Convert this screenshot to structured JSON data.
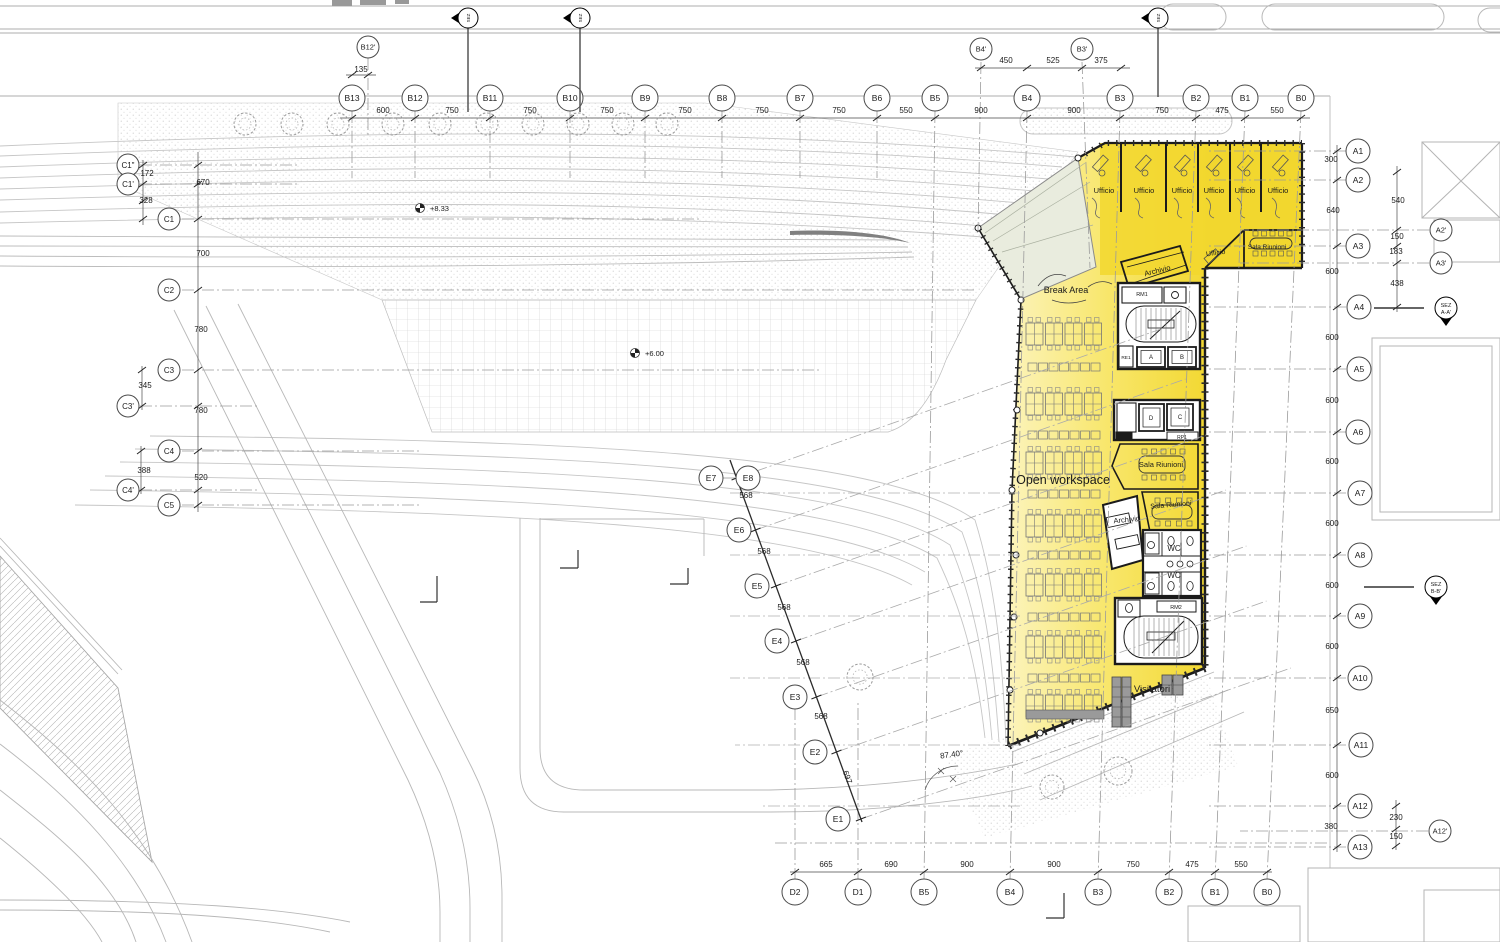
{
  "title": "Office floor plan – first floor (piano primo)",
  "colors": {
    "highlight": "#F2D72E",
    "highlight_pale": "#FCF4BE",
    "glass": "#E9ECDE",
    "wall": "#1B1B1B",
    "desk_gray": "#9A9A9A",
    "line_gray": "#9B9B9B"
  },
  "axes": {
    "groups": [
      {
        "name": "top-b",
        "r": 13,
        "fs": 8.5,
        "tick": "top",
        "items": [
          {
            "id": "B13",
            "x": 352,
            "y": 98
          },
          {
            "id": "B12",
            "x": 415,
            "y": 98
          },
          {
            "id": "B11",
            "x": 490,
            "y": 98
          },
          {
            "id": "B10",
            "x": 570,
            "y": 98
          },
          {
            "id": "B9",
            "x": 645,
            "y": 98
          },
          {
            "id": "B8",
            "x": 722,
            "y": 98
          },
          {
            "id": "B7",
            "x": 800,
            "y": 98
          },
          {
            "id": "B6",
            "x": 877,
            "y": 98
          },
          {
            "id": "B5",
            "x": 935,
            "y": 98
          },
          {
            "id": "B4",
            "x": 1027,
            "y": 98
          },
          {
            "id": "B3",
            "x": 1120,
            "y": 98
          },
          {
            "id": "B2",
            "x": 1196,
            "y": 98
          },
          {
            "id": "B1",
            "x": 1245,
            "y": 98
          },
          {
            "id": "B0",
            "x": 1301,
            "y": 98
          }
        ]
      },
      {
        "name": "top-b-secondary",
        "r": 11,
        "fs": 7.5,
        "tick": "none",
        "items": [
          {
            "id": "B12'",
            "x": 368,
            "y": 47
          },
          {
            "id": "B4'",
            "x": 981,
            "y": 49
          },
          {
            "id": "B3'",
            "x": 1082,
            "y": 49
          }
        ]
      },
      {
        "name": "bottom",
        "r": 13,
        "fs": 8.5,
        "tick": "bottom",
        "items": [
          {
            "id": "D2",
            "x": 795,
            "y": 892
          },
          {
            "id": "D1",
            "x": 858,
            "y": 892
          },
          {
            "id": "B5",
            "x": 924,
            "y": 892
          },
          {
            "id": "B4",
            "x": 1010,
            "y": 892
          },
          {
            "id": "B3",
            "x": 1098,
            "y": 892
          },
          {
            "id": "B2",
            "x": 1169,
            "y": 892
          },
          {
            "id": "B1",
            "x": 1215,
            "y": 892
          },
          {
            "id": "B0",
            "x": 1267,
            "y": 892
          }
        ]
      },
      {
        "name": "left-c",
        "r": 11,
        "fs": 8,
        "tick": "left",
        "items": [
          {
            "id": "C1\"",
            "x": 128,
            "y": 165
          },
          {
            "id": "C1'",
            "x": 128,
            "y": 184
          },
          {
            "id": "C1",
            "x": 169,
            "y": 219
          },
          {
            "id": "C2",
            "x": 169,
            "y": 290
          },
          {
            "id": "C3",
            "x": 169,
            "y": 370
          },
          {
            "id": "C3'",
            "x": 128,
            "y": 406
          },
          {
            "id": "C4",
            "x": 169,
            "y": 451
          },
          {
            "id": "C4'",
            "x": 128,
            "y": 490
          },
          {
            "id": "C5",
            "x": 169,
            "y": 505
          }
        ]
      },
      {
        "name": "right-a",
        "r": 12,
        "fs": 8.5,
        "tick": "right",
        "items": [
          {
            "id": "A1",
            "x": 1358,
            "y": 151
          },
          {
            "id": "A2",
            "x": 1358,
            "y": 180
          },
          {
            "id": "A3",
            "x": 1358,
            "y": 246
          },
          {
            "id": "A4",
            "x": 1359,
            "y": 307
          },
          {
            "id": "A5",
            "x": 1359,
            "y": 369
          },
          {
            "id": "A6",
            "x": 1358,
            "y": 432
          },
          {
            "id": "A7",
            "x": 1360,
            "y": 493
          },
          {
            "id": "A8",
            "x": 1360,
            "y": 555
          },
          {
            "id": "A9",
            "x": 1360,
            "y": 616
          },
          {
            "id": "A10",
            "x": 1360,
            "y": 678
          },
          {
            "id": "A11",
            "x": 1361,
            "y": 745
          },
          {
            "id": "A12",
            "x": 1360,
            "y": 806
          },
          {
            "id": "A13",
            "x": 1360,
            "y": 847
          }
        ]
      },
      {
        "name": "right-a-secondary",
        "r": 11,
        "fs": 7.5,
        "tick": "none",
        "items": [
          {
            "id": "A2'",
            "x": 1441,
            "y": 230
          },
          {
            "id": "A3'",
            "x": 1441,
            "y": 263
          },
          {
            "id": "A12'",
            "x": 1440,
            "y": 831
          }
        ]
      },
      {
        "name": "e-axis",
        "r": 12,
        "fs": 8.5,
        "tick": "e",
        "items": [
          {
            "id": "E7",
            "x": 711,
            "y": 478
          },
          {
            "id": "E8",
            "x": 748,
            "y": 478
          },
          {
            "id": "E6",
            "x": 739,
            "y": 530
          },
          {
            "id": "E5",
            "x": 757,
            "y": 586
          },
          {
            "id": "E4",
            "x": 777,
            "y": 641
          },
          {
            "id": "E3",
            "x": 795,
            "y": 697
          },
          {
            "id": "E2",
            "x": 815,
            "y": 752
          },
          {
            "id": "E1",
            "x": 838,
            "y": 819
          }
        ]
      }
    ],
    "extra_ticks": [
      [
        352,
        75
      ],
      [
        368,
        75
      ],
      [
        981,
        68
      ],
      [
        1027,
        68
      ],
      [
        1082,
        68
      ],
      [
        1121,
        68
      ],
      [
        143,
        165
      ],
      [
        143,
        184
      ],
      [
        143,
        201
      ],
      [
        143,
        219
      ],
      [
        142,
        370
      ],
      [
        142,
        406
      ],
      [
        141,
        451
      ],
      [
        141,
        490
      ],
      [
        1397,
        172
      ],
      [
        1397,
        230
      ],
      [
        1397,
        246
      ],
      [
        1397,
        263
      ],
      [
        1397,
        307
      ],
      [
        1396,
        806
      ],
      [
        1396,
        829
      ],
      [
        1396,
        846
      ]
    ]
  },
  "dims": [
    {
      "t": "135",
      "x": 361,
      "y": 72
    },
    {
      "t": "600",
      "x": 383,
      "y": 113
    },
    {
      "t": "750",
      "x": 452,
      "y": 113
    },
    {
      "t": "750",
      "x": 530,
      "y": 113
    },
    {
      "t": "750",
      "x": 607,
      "y": 113
    },
    {
      "t": "750",
      "x": 685,
      "y": 113
    },
    {
      "t": "750",
      "x": 762,
      "y": 113
    },
    {
      "t": "750",
      "x": 839,
      "y": 113
    },
    {
      "t": "550",
      "x": 906,
      "y": 113
    },
    {
      "t": "900",
      "x": 981,
      "y": 113
    },
    {
      "t": "900",
      "x": 1074,
      "y": 113
    },
    {
      "t": "750",
      "x": 1162,
      "y": 113
    },
    {
      "t": "475",
      "x": 1222,
      "y": 113
    },
    {
      "t": "550",
      "x": 1277,
      "y": 113
    },
    {
      "t": "450",
      "x": 1006,
      "y": 63
    },
    {
      "t": "525",
      "x": 1053,
      "y": 63
    },
    {
      "t": "375",
      "x": 1101,
      "y": 63
    },
    {
      "t": "665",
      "x": 826,
      "y": 867
    },
    {
      "t": "690",
      "x": 891,
      "y": 867
    },
    {
      "t": "900",
      "x": 967,
      "y": 867
    },
    {
      "t": "900",
      "x": 1054,
      "y": 867
    },
    {
      "t": "750",
      "x": 1133,
      "y": 867
    },
    {
      "t": "475",
      "x": 1192,
      "y": 867
    },
    {
      "t": "550",
      "x": 1241,
      "y": 867
    },
    {
      "t": "172",
      "x": 147,
      "y": 176
    },
    {
      "t": "328",
      "x": 146,
      "y": 203
    },
    {
      "t": "670",
      "x": 203,
      "y": 185
    },
    {
      "t": "700",
      "x": 203,
      "y": 256
    },
    {
      "t": "780",
      "x": 201,
      "y": 332
    },
    {
      "t": "345",
      "x": 145,
      "y": 388
    },
    {
      "t": "780",
      "x": 201,
      "y": 413
    },
    {
      "t": "388",
      "x": 144,
      "y": 473
    },
    {
      "t": "520",
      "x": 201,
      "y": 480
    },
    {
      "t": "300",
      "x": 1331,
      "y": 162
    },
    {
      "t": "540",
      "x": 1398,
      "y": 203
    },
    {
      "t": "640",
      "x": 1333,
      "y": 213
    },
    {
      "t": "150",
      "x": 1397,
      "y": 239
    },
    {
      "t": "183",
      "x": 1396,
      "y": 254
    },
    {
      "t": "600",
      "x": 1332,
      "y": 274
    },
    {
      "t": "438",
      "x": 1397,
      "y": 286
    },
    {
      "t": "600",
      "x": 1332,
      "y": 340
    },
    {
      "t": "600",
      "x": 1332,
      "y": 403
    },
    {
      "t": "600",
      "x": 1332,
      "y": 464
    },
    {
      "t": "600",
      "x": 1332,
      "y": 526
    },
    {
      "t": "600",
      "x": 1332,
      "y": 588
    },
    {
      "t": "600",
      "x": 1332,
      "y": 649
    },
    {
      "t": "650",
      "x": 1332,
      "y": 713
    },
    {
      "t": "600",
      "x": 1332,
      "y": 778
    },
    {
      "t": "230",
      "x": 1396,
      "y": 820
    },
    {
      "t": "380",
      "x": 1331,
      "y": 829
    },
    {
      "t": "150",
      "x": 1396,
      "y": 839
    },
    {
      "t": "568",
      "x": 746,
      "y": 498
    },
    {
      "t": "568",
      "x": 764,
      "y": 554
    },
    {
      "t": "568",
      "x": 784,
      "y": 610
    },
    {
      "t": "568",
      "x": 803,
      "y": 665
    },
    {
      "t": "568",
      "x": 821,
      "y": 719
    },
    {
      "t": "697",
      "x": 845,
      "y": 778,
      "r": 70
    }
  ],
  "labels": [
    {
      "t": "Ufficio",
      "x": 1104,
      "y": 193,
      "s": 7.5
    },
    {
      "t": "Ufficio",
      "x": 1144,
      "y": 193,
      "s": 7.5
    },
    {
      "t": "Ufficio",
      "x": 1182,
      "y": 193,
      "s": 7.5
    },
    {
      "t": "Ufficio",
      "x": 1214,
      "y": 193,
      "s": 7.5
    },
    {
      "t": "Ufficio",
      "x": 1245,
      "y": 193,
      "s": 7.5
    },
    {
      "t": "Ufficio",
      "x": 1278,
      "y": 193,
      "s": 7.5
    },
    {
      "t": "Ufficio",
      "x": 1216,
      "y": 255,
      "s": 7,
      "r": -8
    },
    {
      "t": "Sala Riunioni",
      "x": 1267,
      "y": 249,
      "s": 6.5
    },
    {
      "t": "Archivio",
      "x": 1158,
      "y": 273,
      "s": 7.5,
      "r": -14
    },
    {
      "t": "Break Area",
      "x": 1066,
      "y": 293,
      "s": 9
    },
    {
      "t": "RM1",
      "x": 1142,
      "y": 296,
      "s": 5.5
    },
    {
      "t": "RE1",
      "x": 1126,
      "y": 359,
      "s": 4.8
    },
    {
      "t": "A",
      "x": 1151,
      "y": 359,
      "s": 6
    },
    {
      "t": "B",
      "x": 1182,
      "y": 359,
      "s": 6
    },
    {
      "t": "D",
      "x": 1151,
      "y": 420,
      "s": 6
    },
    {
      "t": "C",
      "x": 1180,
      "y": 419,
      "s": 6
    },
    {
      "t": "RP1",
      "x": 1182,
      "y": 439,
      "s": 5
    },
    {
      "t": "Sala Riunioni",
      "x": 1161,
      "y": 467,
      "s": 7.5
    },
    {
      "t": "Sala Riunioni",
      "x": 1171,
      "y": 507,
      "s": 7,
      "r": -5
    },
    {
      "t": "Archivio",
      "x": 1127,
      "y": 522,
      "s": 7.5,
      "r": -6
    },
    {
      "t": "WC",
      "x": 1174,
      "y": 551,
      "s": 8
    },
    {
      "t": "WC",
      "x": 1174,
      "y": 578,
      "s": 8
    },
    {
      "t": "RM2",
      "x": 1176,
      "y": 609,
      "s": 5.5
    },
    {
      "t": "Open workspace",
      "x": 1063,
      "y": 484,
      "s": 12.5
    },
    {
      "t": "Visitatori",
      "x": 1152,
      "y": 692,
      "s": 9.5
    },
    {
      "t": "87.40°",
      "x": 952,
      "y": 757,
      "s": 8,
      "r": -8
    }
  ],
  "levels": [
    {
      "t": "+8.33",
      "tx": 430,
      "ty": 211,
      "sx": 420,
      "sy": 208
    },
    {
      "t": "+6.00",
      "tx": 645,
      "ty": 356,
      "sx": 635,
      "sy": 353
    }
  ],
  "section_markers": [
    {
      "t1": "SEZ",
      "t2": "",
      "x": 468,
      "y": 18,
      "dir": "left",
      "stem": 112
    },
    {
      "t1": "SEZ",
      "t2": "",
      "x": 580,
      "y": 18,
      "dir": "left",
      "stem": 112
    },
    {
      "t1": "SEZ",
      "t2": "",
      "x": 1158,
      "y": 18,
      "dir": "left",
      "stem": 97
    },
    {
      "t1": "SEZ",
      "t2": "A-A'",
      "x": 1446,
      "y": 308,
      "dir": "down",
      "lead": 50
    },
    {
      "t1": "SEZ",
      "t2": "B-B'",
      "x": 1436,
      "y": 587,
      "dir": "down",
      "lead": 50
    }
  ],
  "site": {
    "trees": [
      [
        245,
        124,
        11
      ],
      [
        292,
        124,
        11
      ],
      [
        338,
        124,
        11
      ],
      [
        393,
        124,
        11
      ],
      [
        440,
        124,
        11
      ],
      [
        487,
        124,
        11
      ],
      [
        533,
        124,
        11
      ],
      [
        578,
        124,
        11
      ],
      [
        623,
        124,
        11
      ],
      [
        667,
        124,
        11
      ],
      [
        860,
        677,
        13
      ],
      [
        1052,
        787,
        12
      ],
      [
        1118,
        771,
        14
      ]
    ]
  },
  "workspace": {
    "cluster_rows": [
      334,
      404,
      463,
      526,
      585,
      647,
      706
    ],
    "single_rows": [
      367,
      435,
      494,
      555,
      617,
      678
    ],
    "x0": 1026,
    "pod_w": 17,
    "pod_step": 19.5,
    "pod_h": 22,
    "pods": 4,
    "gray_bar": {
      "x": 1026,
      "y": 710,
      "w": 78,
      "h": 9
    }
  },
  "visitatori": {
    "pods": [
      {
        "x": 1112,
        "y": 677,
        "w": 9,
        "h": 50,
        "cells": 5
      },
      {
        "x": 1122,
        "y": 677,
        "w": 9,
        "h": 50,
        "cells": 5
      },
      {
        "x": 1162,
        "y": 675,
        "w": 10,
        "h": 20,
        "cells": 2
      },
      {
        "x": 1173,
        "y": 675,
        "w": 10,
        "h": 20,
        "cells": 2
      }
    ]
  },
  "ufficio_desks": [
    1100,
    1143,
    1182,
    1214,
    1245,
    1280
  ]
}
